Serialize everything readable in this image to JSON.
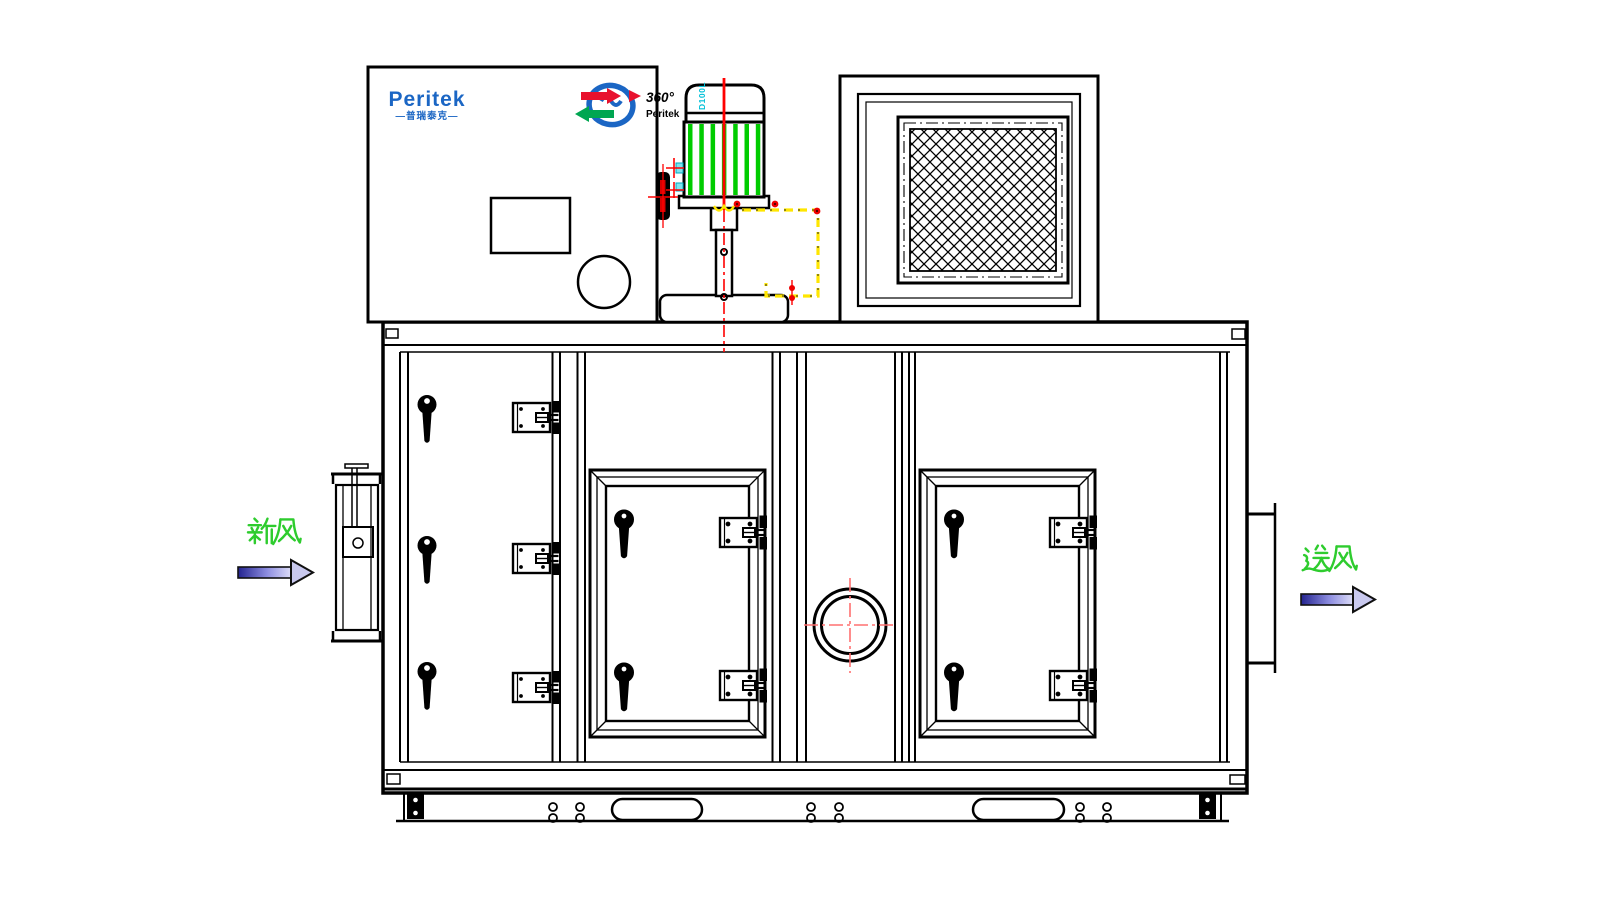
{
  "drawing": {
    "brand": {
      "name": "Peritek",
      "subtitle": "—普瑞泰克—",
      "rotor_degree": "360°",
      "rotor_brand": "Peritek"
    },
    "flow_labels": {
      "inlet": "新风",
      "outlet": "送风"
    },
    "motor": {
      "marking": "D100L"
    },
    "colors": {
      "logo_blue": "#1b66c4",
      "logo_red": "#e8112d",
      "logo_green": "#00a651",
      "label_green": "#2ecc2e",
      "motor_green": "#00cc00",
      "detail_cyan": "#00c0d8",
      "highlight_yellow": "#ffe600",
      "centerline_red": "#ff0000",
      "crosshair_red": "#ff7070",
      "arrow_dark_blue": "#23238f",
      "arrow_light_blue": "#dcdcf8",
      "line_black": "#000000"
    }
  }
}
